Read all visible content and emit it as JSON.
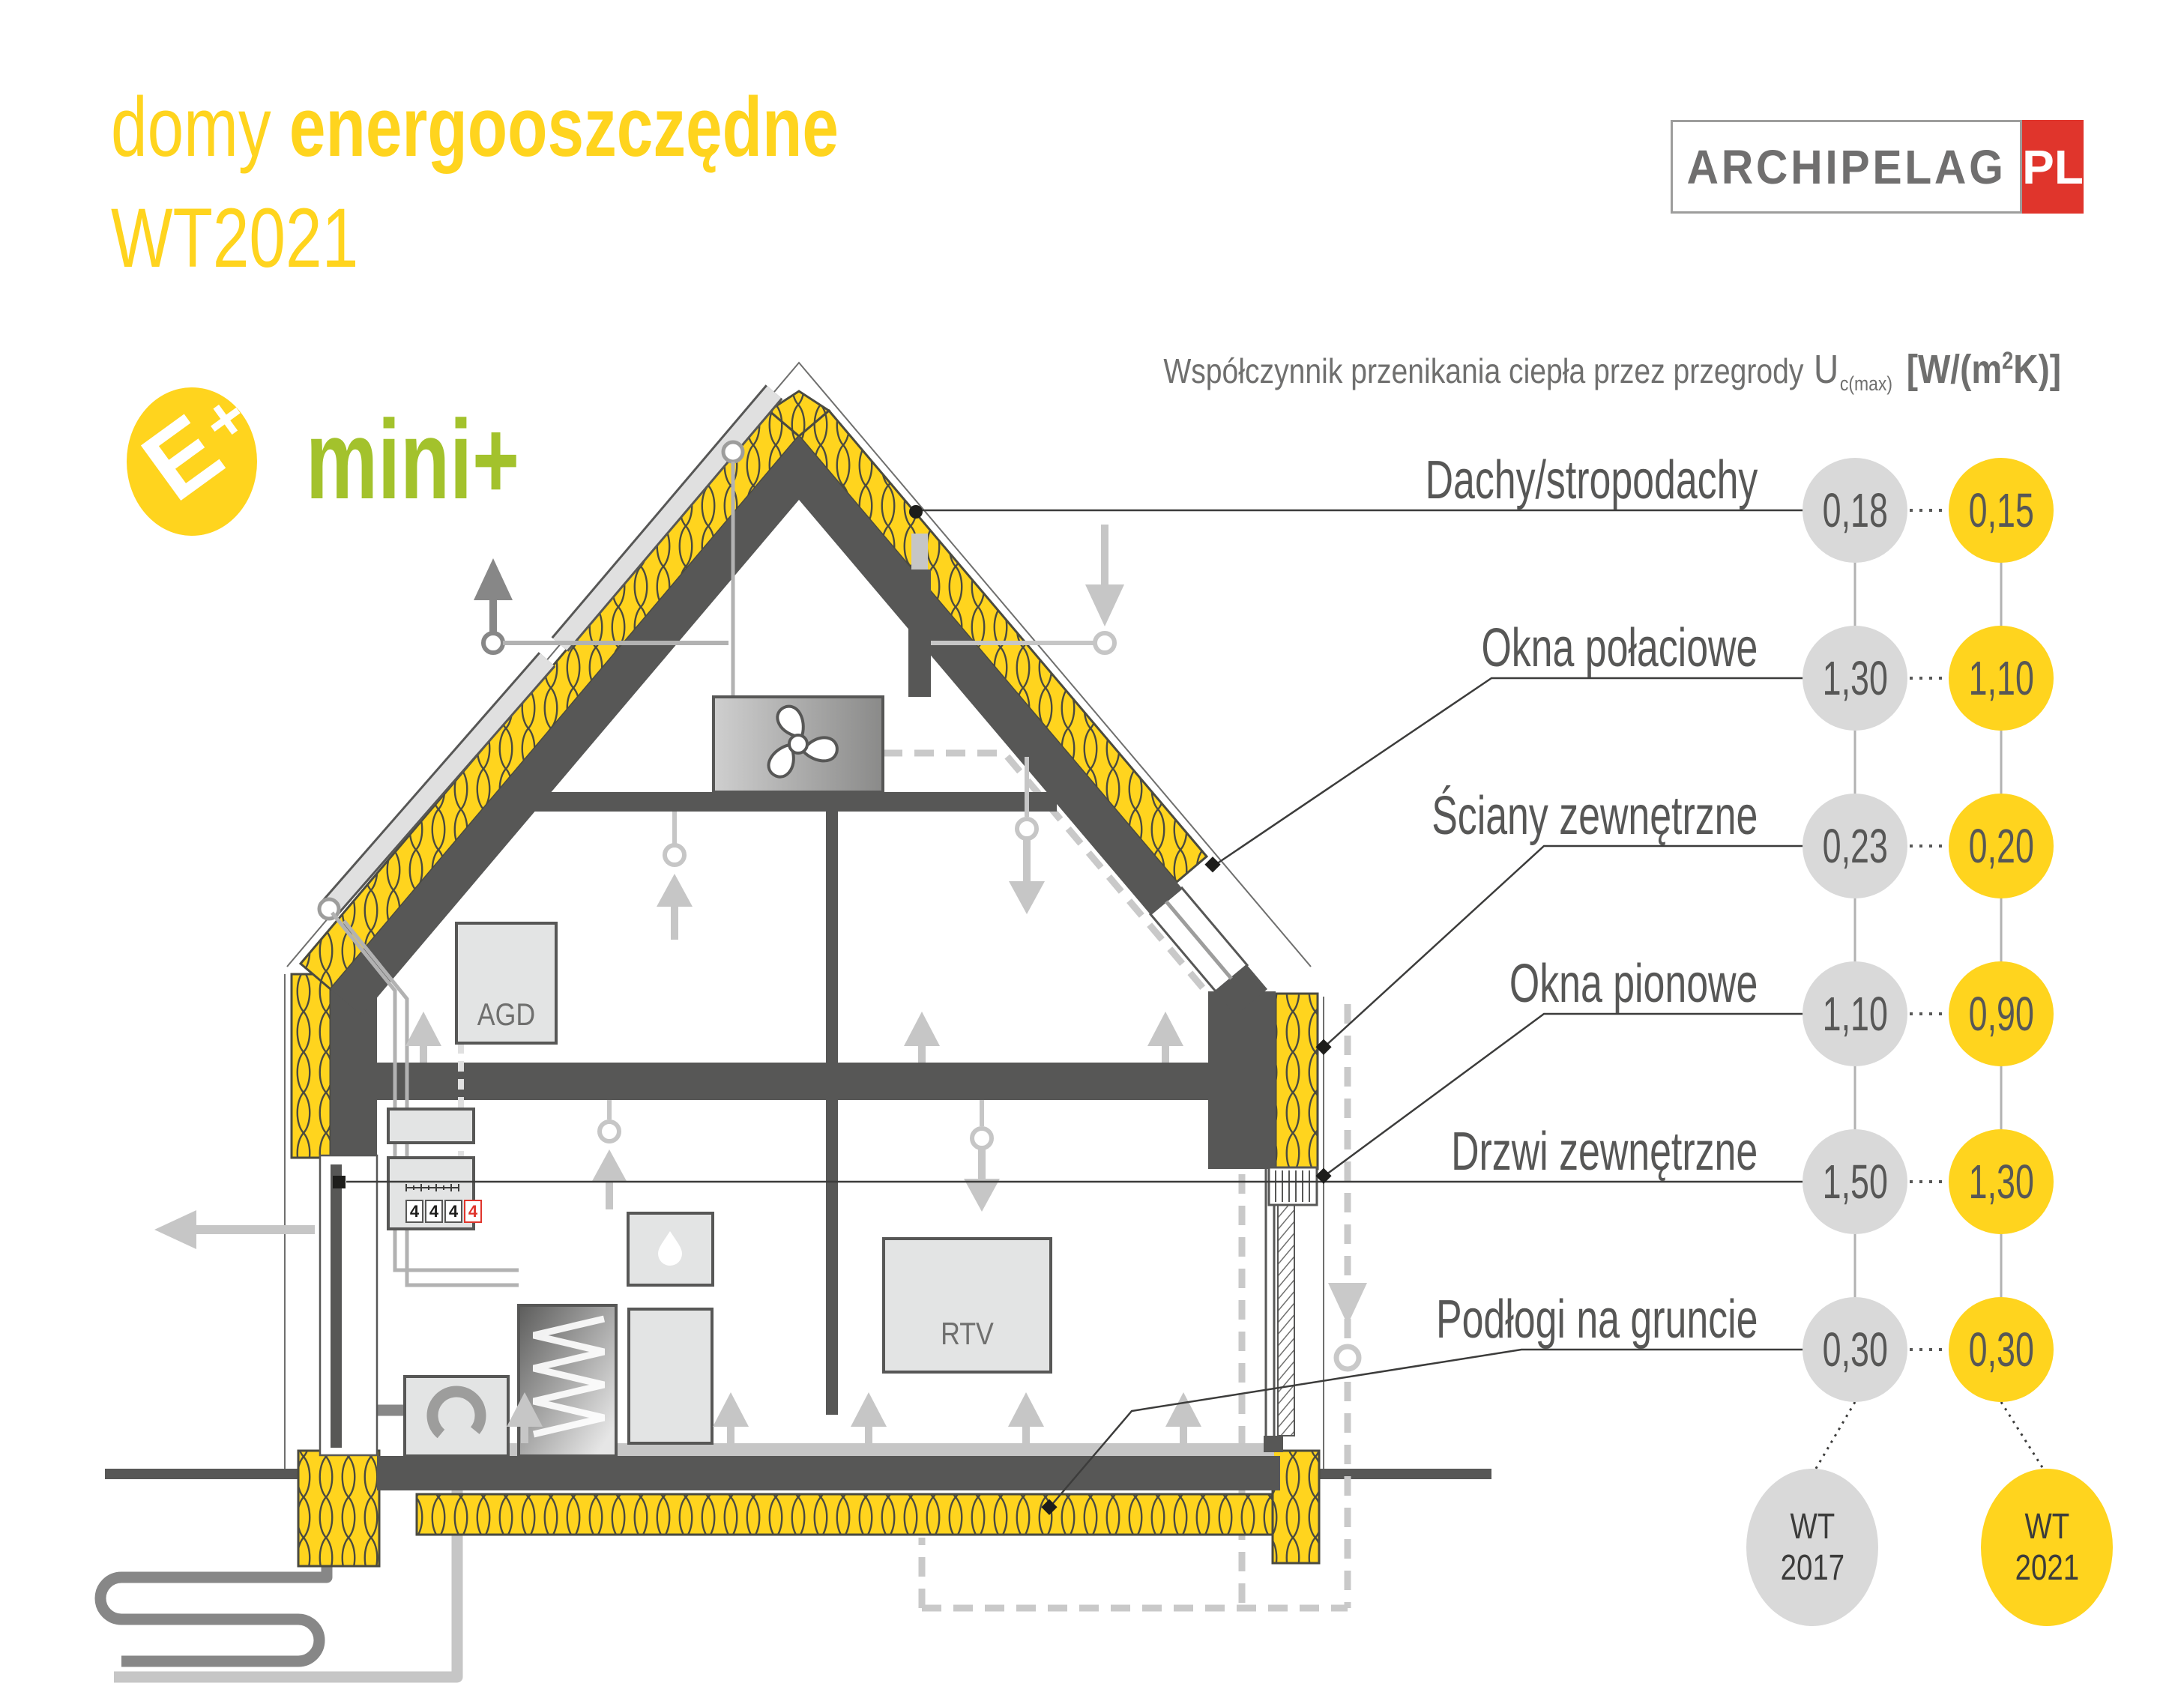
{
  "title": {
    "line1_light": "domy",
    "line1_bold": "energooszczędne",
    "line2": "WT2021"
  },
  "logo": {
    "word": "ARCHIPELAG",
    "tld": "PL"
  },
  "badge": {
    "e_letter": "E",
    "e_plus": "+",
    "label": "mini+"
  },
  "header": {
    "text": "Współczynnik przenikania ciepła przez przegrody",
    "symbol": "U",
    "symbol_sub": "c(max)",
    "unit_prefix": "[W/(m",
    "unit_sup": "2",
    "unit_suffix": "K)]"
  },
  "rows": [
    {
      "label": "Dachy/stropodachy",
      "wt2017": "0,18",
      "wt2021": "0,15"
    },
    {
      "label": "Okna połaciowe",
      "wt2017": "1,30",
      "wt2021": "1,10"
    },
    {
      "label": "Ściany zewnętrzne",
      "wt2017": "0,23",
      "wt2021": "0,20"
    },
    {
      "label": "Okna pionowe",
      "wt2017": "1,10",
      "wt2021": "0,90"
    },
    {
      "label": "Drzwi zewnętrzne",
      "wt2017": "1,50",
      "wt2021": "1,30"
    },
    {
      "label": "Podłogi na gruncie",
      "wt2017": "0,30",
      "wt2021": "0,30"
    }
  ],
  "columns": {
    "wt2017": {
      "line1": "WT",
      "line2": "2017"
    },
    "wt2021": {
      "line1": "WT",
      "line2": "2021"
    }
  },
  "house": {
    "agd_label": "AGD",
    "rtv_label": "RTV",
    "meter_digits": [
      "4",
      "4",
      "4",
      "4"
    ]
  },
  "chart_data": {
    "type": "table",
    "title": "Współczynnik przenikania ciepła przez przegrody Uc(max) [W/(m2K)]",
    "categories": [
      "Dachy/stropodachy",
      "Okna połaciowe",
      "Ściany zewnętrzne",
      "Okna pionowe",
      "Drzwi zewnętrzne",
      "Podłogi na gruncie"
    ],
    "series": [
      {
        "name": "WT 2017",
        "values": [
          0.18,
          1.3,
          0.23,
          1.1,
          1.5,
          0.3
        ]
      },
      {
        "name": "WT 2021",
        "values": [
          0.15,
          1.1,
          0.2,
          0.9,
          1.3,
          0.3
        ]
      }
    ]
  },
  "colors": {
    "brand_yellow": "#FFD41E",
    "brand_green": "#A3C22C",
    "brand_red": "#E0352C",
    "dark_gray": "#575756",
    "mid_gray": "#9d9d9c",
    "light_gray": "#c6c6c6",
    "circle_gray": "#d9d9d9",
    "text_gray": "#6f6f6e"
  }
}
